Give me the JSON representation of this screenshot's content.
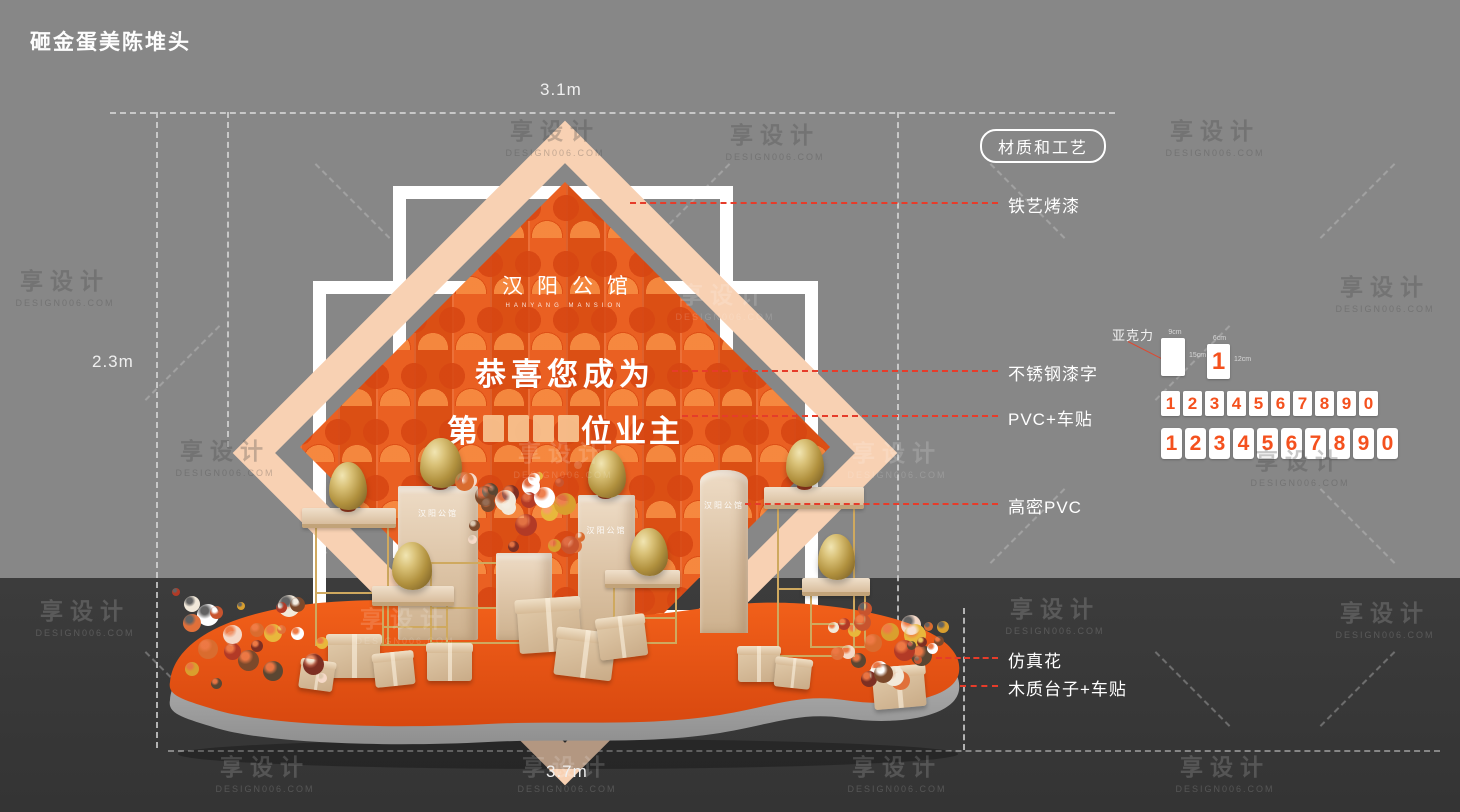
{
  "title": "砸金蛋美陈堆头",
  "dims": {
    "top": "3.1m",
    "left": "2.3m",
    "bottom": "3.7m"
  },
  "backdrop": {
    "logo": "汉阳公馆",
    "logo_en": "HANYANG MANSION",
    "congrats": "恭喜您成为",
    "owner_prefix": "第",
    "owner_suffix": "位业主",
    "pedestal_brand": "汉阳公馆"
  },
  "materials": {
    "title": "材质和工艺",
    "items": [
      "铁艺烤漆",
      "不锈钢漆字",
      "PVC+车贴",
      "高密PVC",
      "仿真花",
      "木质台子+车贴"
    ]
  },
  "acrylic": {
    "label": "亚克力",
    "sample_digit": "1",
    "tick_top_blank": "9cm",
    "tick_right_blank": "15cm",
    "tick_top_digit": "6cm",
    "tick_right_digit": "12cm",
    "row1": [
      "1",
      "2",
      "3",
      "4",
      "5",
      "6",
      "7",
      "8",
      "9",
      "0"
    ],
    "row2": [
      "1",
      "2",
      "3",
      "4",
      "5",
      "6",
      "7",
      "8",
      "9",
      "0"
    ]
  },
  "watermark": {
    "line1": "享设计",
    "line2": "DESIGN006.COM"
  },
  "colors": {
    "accent_orange": "#e65416",
    "peach": "#f8d1b3",
    "callout_red": "#e63c2a",
    "gold": "#cfa95f",
    "champagne": "#dcc3a5",
    "bg_gray": "#878787",
    "floor_dark": "#3c3c3c",
    "white": "#ffffff"
  }
}
